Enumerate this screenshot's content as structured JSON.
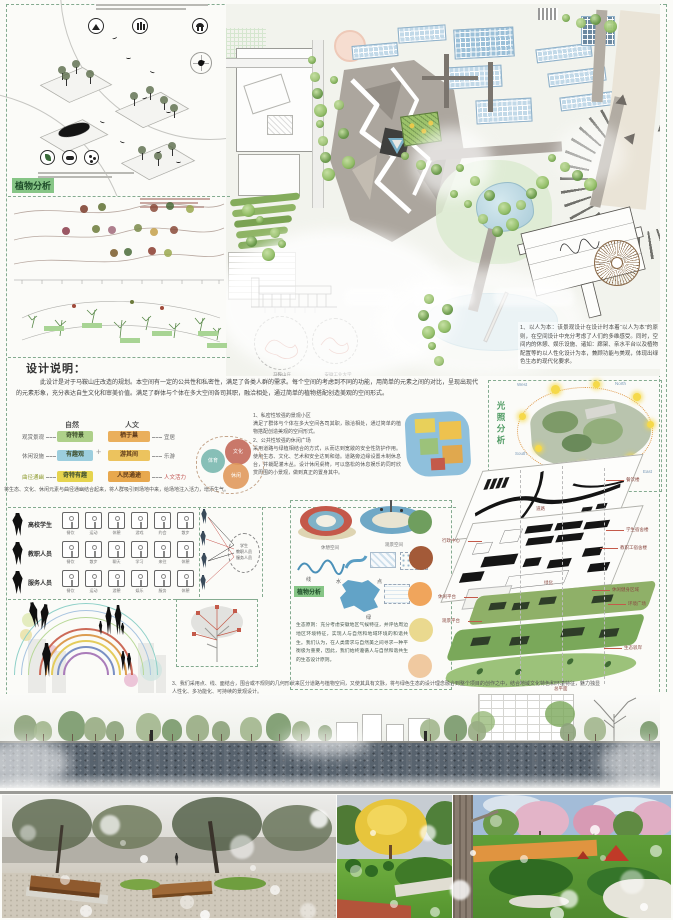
{
  "labels": {
    "plant_analysis": "植物分析",
    "design_title": "设计说明：",
    "light_analysis": "光照分析",
    "nature": "自然",
    "human": "人文",
    "plus": "+"
  },
  "design": {
    "paragraph": "此设计是对于马鞍山庄改造的规划。本空间有一定的公共性和私密性，满足了各类人群的需求。每个空间的考虑到不同的功能，用简单的元素之间的对比，呈现出现代的元素形象，充分表达自生文化和审美价值。满足了群体与个体在多大空间各司其职，融洽相处，通过简单的植物搭配创造美观的空间形式。",
    "items": "1、私密性较强的景观小区\n满足了群体与个体在多大空间各司其职，融洽相处，通过简单的植物搭配创造美观的空间形式。\n2、公共性较强的休闲广场\n采用道路与绿植相结合的方式，从而达到宽敞的安全性防护作用。使用生态、文化、艺术和安全达到和谐。道路旁边缘设置木制休息台，并栽配灌木丛。设计休闲桌椅，可以悠松的休息娱乐的同时欣赏周围的小景观，做到真正的置身其中。"
  },
  "flow": {
    "rows": [
      {
        "left": "观赏景观",
        "nature": "奇特景",
        "human": "栖于巢",
        "right": "宜居"
      },
      {
        "left": "休闲设施",
        "nature": "有趣观",
        "human": "游其间",
        "right": "乐游"
      },
      {
        "left": "曲径通幽",
        "nature": "奇特有趣",
        "human": "人民通途",
        "right": "人文活力"
      }
    ],
    "note": "将生态、文化、休闲元素与曲径通幽结合起来，将人群吸引到场地中来，给场地注入活力，增添生气。"
  },
  "venn": {
    "a": "体育",
    "b": "文化",
    "c": "休闲"
  },
  "principles": {
    "p1": "1、以人为本：该景观设计在设计时本着“以人为本”的原则，在空间设计中充分考虑了人们的多维感受。同时，空间内的休憩、娱乐设施、诸如：廊架、亲水平台以及植物配置等的以人性化设计为本，兼顾功能与美观，体现出绿色生态的现代化要求。",
    "p3": "3、我们采用点、线、面结合，围合或不规则的几何形状来区分道路与植物空间，又使其具有文脉，将与绿色生态的设计理念融合到整个项目的创作之中，结合地域文化特色和环境特征，魅力独显人性化、多功能化、可持续的景观设计。"
  },
  "eco": {
    "text": "生态原则：充分考虑安徽地区气候特征，并评估周边地区环境特征，实现人与自然和地域环境的和谐共生。我们认为，在人类需求与自然美之间寻求一种平衡极为重要，因此，我们始终遵循人与自然和谐共生的生态设计原则。"
  },
  "light": {
    "west": "West",
    "north": "North",
    "south": "South",
    "east": "East"
  },
  "users": {
    "groups": [
      {
        "name": "高校学生",
        "acts": [
          "餐饮",
          "运动",
          "休憩",
          "游戏",
          "约会",
          "散步"
        ]
      },
      {
        "name": "教职人员",
        "acts": [
          "餐饮",
          "散步",
          "聊天",
          "学习",
          "来往",
          "休憩"
        ]
      },
      {
        "name": "服务人员",
        "acts": [
          "餐饮",
          "运动",
          "游憩",
          "娱乐",
          "服务",
          "休憩"
        ]
      }
    ],
    "bubble": "学生\n教职人员\n服务人员"
  },
  "spaces": {
    "cap1": "休憩空间",
    "cap2": "观景空间",
    "e1": "线",
    "e2": "水",
    "e3": "点",
    "e4": "绿"
  },
  "plan": {
    "site1": "马鞍山庄",
    "site2": "安徽工业大学"
  },
  "axon": {
    "labels": [
      "餐饮楼",
      "道路",
      "学生宿舍楼",
      "教职工宿舍楼",
      "行政中心",
      "休闲平台",
      "休闲健身区域",
      "环境广场",
      "绿化",
      "观景平台",
      "生态驳岸",
      "总平面"
    ]
  },
  "colors": {
    "accent_green": "#84ab90",
    "chip_green": "#86c586",
    "red_text": "#c0504d"
  }
}
